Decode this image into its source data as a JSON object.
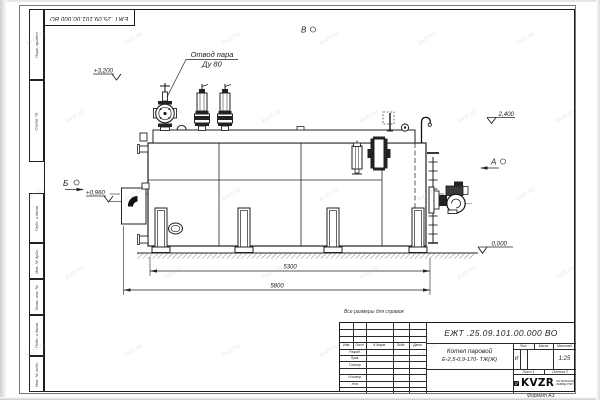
{
  "sheet": {
    "doc_number": "ЕЖТ .25.09.101.00.000  ВО",
    "title_line1": "Котел паровой",
    "title_line2": "Е-2,5-0,9-170- ТЖ(Ж)",
    "note": "Все размеры для справок",
    "format_label": "Формат А3",
    "scale_value": "1:25",
    "lit_value": "И",
    "sheet_label": "Лист 1",
    "sheets_label": "Листов 2",
    "headers": {
      "lit": "Лит.",
      "mass": "Масса",
      "scale": "Масштаб"
    },
    "columns": [
      "Изм.",
      "Лист",
      "N докум.",
      "Подп.",
      "Дата"
    ],
    "roles": [
      "Разраб.",
      "Пров.",
      "Т.контр.",
      "Н.контр.",
      "Утв."
    ],
    "side_stamps": [
      "Перв. примен.",
      "Справ. №",
      "Подп. и дата",
      "Инв. № дубл.",
      "Взам. инв. №",
      "Подп. и дата",
      "Инв. № подл."
    ],
    "logo": {
      "text": "KVZR",
      "sub1": "КОТЕЛЬНЫЙ",
      "sub2": "ЗАВОД РЭП"
    }
  },
  "drawing": {
    "callout": {
      "line1": "Отвод пара",
      "line2": "Ду 80"
    },
    "elevations": {
      "top": "+3,200",
      "deck": "2,400",
      "door": "+0,960",
      "ground": "0,000"
    },
    "views": {
      "b": "Б",
      "a": "А",
      "v": "В"
    },
    "dimensions": {
      "inner": "5300",
      "overall": "5800"
    }
  },
  "colors": {
    "ink": "#222222",
    "paper": "#ffffff"
  },
  "watermark": {
    "text": "kvzr.ru"
  }
}
